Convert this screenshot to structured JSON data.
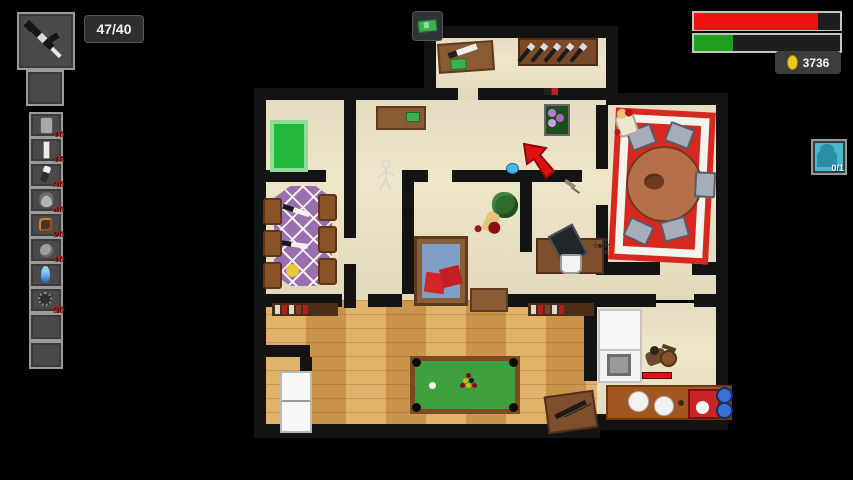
{
  "hud": {
    "ammo": "47/40",
    "money": {
      "value": "3736",
      "coin_color": "#f2c61d"
    },
    "bars": {
      "health": {
        "fill": "85%",
        "color": "#ee1111"
      },
      "armor": {
        "fill": "27%",
        "color": "#1f9e1f"
      }
    },
    "objective_button": {
      "icon": "cash-icon"
    },
    "person_counter": {
      "value": "0/1",
      "bg_color": "#49b8cc"
    },
    "weapon_slot": {
      "icon": "rifle-icon"
    },
    "inventory": {
      "slots": [
        {
          "item": "grenade",
          "count": "10"
        },
        {
          "item": "syringe",
          "count": "15"
        },
        {
          "item": "molotov",
          "count": "30"
        },
        {
          "item": "mask",
          "count": "40"
        },
        {
          "item": "bomb",
          "count": "20"
        },
        {
          "item": "mine",
          "count": "10"
        },
        {
          "item": "potion",
          "count": ""
        },
        {
          "item": "bear-trap",
          "count": "30"
        },
        {
          "item": "",
          "count": ""
        },
        {
          "item": "",
          "count": ""
        }
      ]
    }
  },
  "map": {
    "enemy_health_bar": {
      "color": "#e01010"
    },
    "objective_arrow_color": "#e01010",
    "carpet_color": "#d6281e",
    "pool_felt_color": "#3fa03f",
    "dining_table_color": "#9a6fb0"
  }
}
